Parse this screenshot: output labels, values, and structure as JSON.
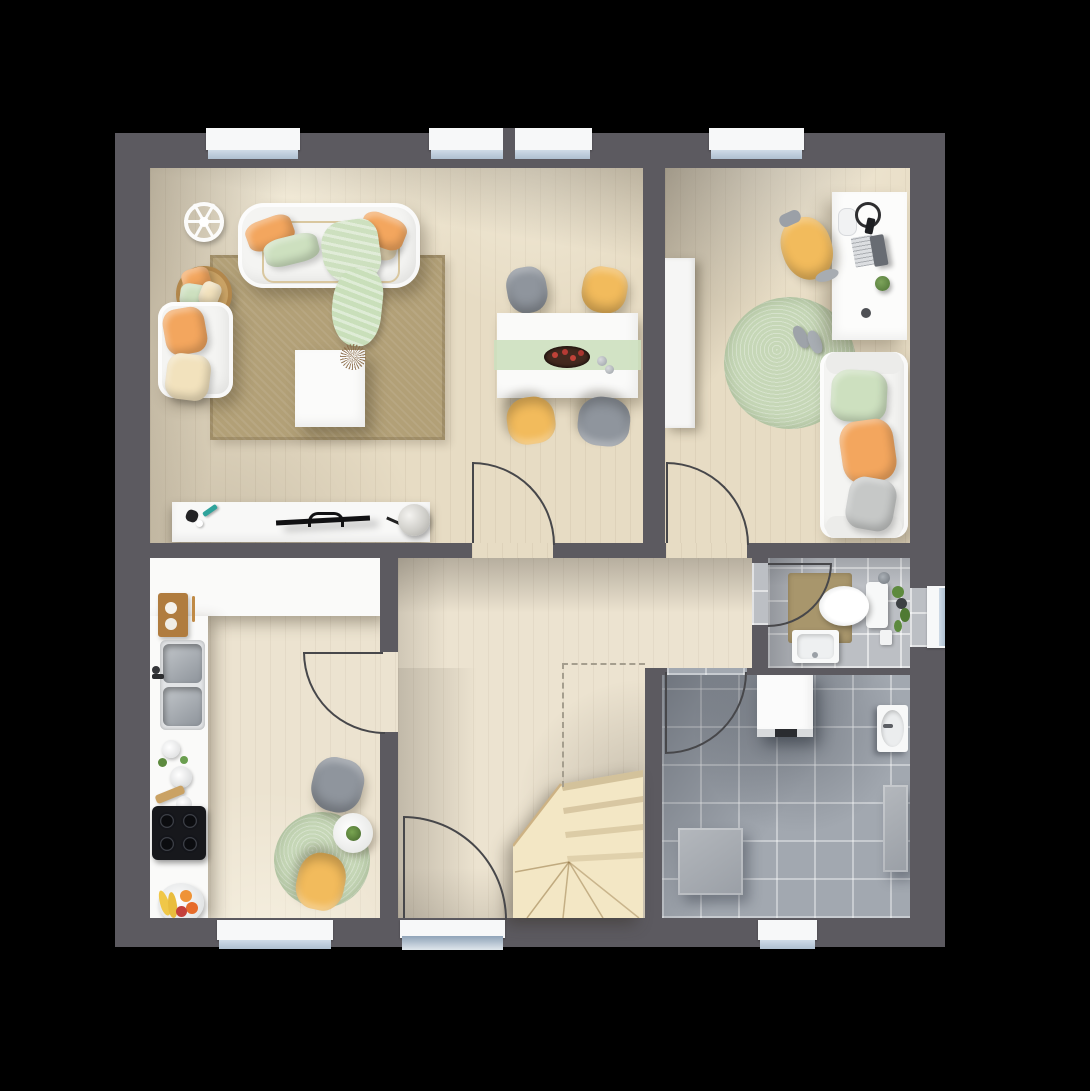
{
  "scene": {
    "type": "floor-plan",
    "view": "top-down-3d-render",
    "storey": "ground floor with winder staircase",
    "background": "#000000"
  },
  "palette": {
    "wall": "#5c5a60",
    "wood": "#e7dcc4",
    "wood_light": "#ece3d0",
    "tile_bath": "#bcbfc4",
    "tile_utility": "#a2a8b0",
    "stairs": "#f3e7c5",
    "stairs_edge": "#c9ae7e",
    "rug_tan": "#b2a077",
    "rug_green": "#c6d7b7",
    "orange": "#f3a65e",
    "yellow": "#f2bb5c",
    "mint": "#cde0bf",
    "cream": "#f2e2bd",
    "chair_gray": "#8f959d",
    "white": "#f4f4f2",
    "glass": "#cfdbe7",
    "sill": "#f7f8f9",
    "door_line": "#47474a",
    "cooktop": "#17181c",
    "wood_board": "#b07c3f",
    "mat_tan": "#a8966c"
  },
  "rooms": [
    {
      "id": "living-dining-room",
      "floor": "wood",
      "position": "top-left"
    },
    {
      "id": "home-office",
      "floor": "wood",
      "position": "top-right"
    },
    {
      "id": "kitchen",
      "floor": "wood",
      "position": "bottom-left"
    },
    {
      "id": "hallway",
      "floor": "wood",
      "position": "center-bottom"
    },
    {
      "id": "bathroom",
      "floor": "gray-tile",
      "position": "middle-right"
    },
    {
      "id": "utility-room",
      "floor": "gray-tile",
      "position": "bottom-right"
    }
  ],
  "furniture": {
    "living_dining": [
      "white-sofa",
      "orange-mint-cream-cushions",
      "mint-throw-blanket",
      "decor-wheel",
      "pillow-basket",
      "white-armchair",
      "white-coffee-table",
      "tan-area-rug",
      "tv-sideboard",
      "flat-tv",
      "remote-and-decor",
      "pompom-decor",
      "dining-table",
      "mint-table-runner",
      "berry-bowl",
      "gray-dining-chair",
      "yellow-dining-chair",
      "yellow-dining-chair",
      "gray-dining-chair"
    ],
    "home_office": [
      "tall-white-cabinet",
      "white-desk",
      "laptop",
      "headphones",
      "mousepad",
      "smartphone",
      "desk-plant",
      "yellow-desk-chair",
      "round-green-rug",
      "slippers",
      "white-sofa-green-orange-gray-cushions"
    ],
    "kitchen": [
      "l-shaped-white-counter",
      "wood-cutting-board",
      "double-stainless-sink",
      "dish-stack",
      "black-cooktop",
      "fruit-plate",
      "round-green-rug",
      "round-bistro-table",
      "table-plant",
      "gray-chair",
      "yellow-chair"
    ],
    "hallway": [
      "winder-staircase",
      "stair-outline-dashed",
      "entrance-door"
    ],
    "bathroom": [
      "toilet",
      "tan-bath-mat",
      "washbasin",
      "shower-head",
      "hanging-plant",
      "small-bin"
    ],
    "utility_room": [
      "washing-machine",
      "wall-sink",
      "tall-gray-cabinet",
      "gray-storage-box"
    ]
  },
  "openings": {
    "windows_top_wall": 3,
    "windows_bottom_wall": 2,
    "windows_right_wall": 1,
    "entrance_door_bottom": 1,
    "interior_doors": 5
  },
  "stairs": {
    "type": "winder",
    "location": "hallway-bottom-right",
    "treads_visible": 8
  }
}
